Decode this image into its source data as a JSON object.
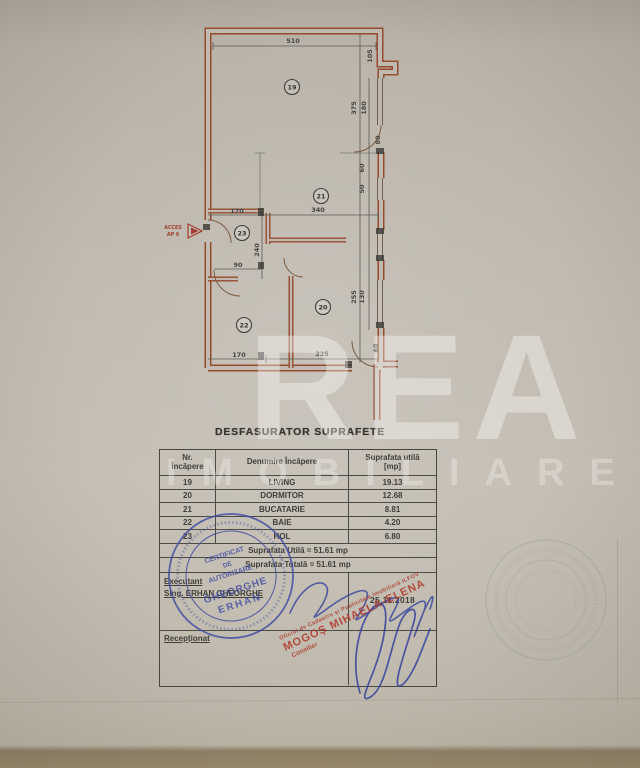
{
  "document": {
    "title": "DESFASURATOR SUPRAFETE"
  },
  "watermark": {
    "brand": "REA",
    "subtitle": "IMOBILIARE"
  },
  "plan": {
    "access": {
      "line1": "ACCES",
      "line2": "AP 9"
    },
    "rooms": {
      "living": "19",
      "dormitor": "20",
      "bucatarie": "21",
      "baie": "22",
      "hol": "23"
    },
    "dims": {
      "top": "510",
      "right": [
        "105",
        "375",
        "180",
        "80",
        "60",
        "50",
        "255",
        "130",
        "60"
      ],
      "mid": [
        "170",
        "340",
        "90",
        "240"
      ],
      "bottom": [
        "170",
        "325"
      ]
    }
  },
  "table": {
    "headers": {
      "col1_line1": "Nr.",
      "col1_line2": "Încăpere",
      "col2": "Denumire  Încăpere",
      "col3_line1": "Suprafata utilă",
      "col3_line2": "[mp]"
    },
    "rows": [
      {
        "nr": "19",
        "name": "LIVING",
        "area": "19.13"
      },
      {
        "nr": "20",
        "name": "DORMITOR",
        "area": "12.68"
      },
      {
        "nr": "21",
        "name": "BUCATARIE",
        "area": "8.81"
      },
      {
        "nr": "22",
        "name": "BAIE",
        "area": "4.20"
      },
      {
        "nr": "23",
        "name": "HOL",
        "area": "6.80"
      }
    ],
    "summary_utila": "Suprafata Utilă  =  51.61 mp",
    "summary_totala": "Suprafata Totală =  51.61 mp",
    "executant_label": "Executant",
    "executant_name": "Sing. ERHAN GHEORGHE",
    "date": "25.11.2018",
    "receptionat_label": "Recepționat"
  },
  "stamps": {
    "round_blue": {
      "line1": "CERTIFICAT",
      "line2": "DE",
      "line3": "AUTORIZARE",
      "name_line1": "GHEORGHE",
      "name_line2": "ERHAN",
      "color": "#3b4aa0"
    },
    "red": {
      "small_top": "Oficiul de Cadastru și Publicitate Imobiliară ILFOV",
      "name": "MOGOȘ MIHAELA-ELENA",
      "small_bottom": "Consilier",
      "color": "#b23a2c"
    }
  },
  "colors": {
    "paper": "#c2bcb2",
    "wall": "#96492b",
    "ink": "#3d3c38",
    "stamp_blue": "#3b4aa0",
    "stamp_red": "#b23a2c"
  }
}
